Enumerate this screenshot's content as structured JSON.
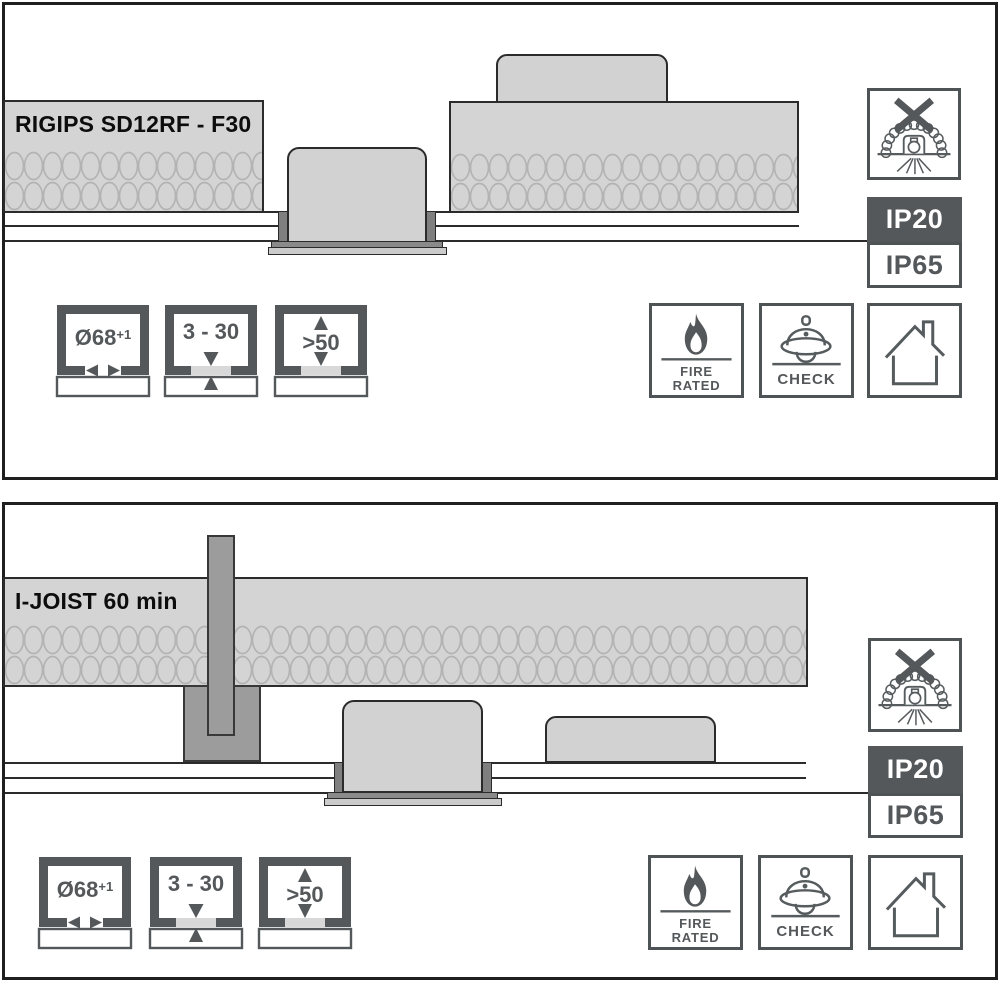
{
  "document": {
    "kind": "luminaire fire-rated ceiling installation diagram"
  },
  "panels": [
    {
      "label": "RIGIPS SD12RF - F30"
    },
    {
      "label": "I-JOIST 60 min"
    }
  ],
  "ratings": {
    "above_ceiling": "IP20",
    "below_ceiling": "IP65"
  },
  "dimensions": {
    "cutout": "Ø68",
    "cutout_tolerance": "+1",
    "ceiling_thickness": "3 - 30",
    "clearance": ">50"
  },
  "marks": {
    "fire_line1": "FIRE",
    "fire_line2": "RATED",
    "check": "CHECK"
  },
  "icons": {
    "no_insulation_cover": "no-insulation-cover-icon",
    "fire_rated": "fire-rated-icon",
    "helmet_check": "fire-helmet-check-icon",
    "house": "house-icon",
    "cutout": "cutout-diameter-icon",
    "thickness": "ceiling-thickness-icon",
    "clearance": "clearance-above-icon",
    "insulation": "insulation-loops"
  },
  "colors": {
    "panel_border": "#1f1f1f",
    "diagram_line": "#2b2b2b",
    "insulation_fill": "#d4d4d4",
    "insulation_loop": "#b3b3b3",
    "fixture_fill": "#d2d2d2",
    "clamp_fill": "#7f7f7f",
    "joist_fill": "#9c9c9c",
    "trim_dark": "#8a8a8a",
    "trim_light": "#cbcbcb",
    "accent_dark": "#54585a",
    "ip20_bg": "#54585a",
    "gap_segment": "#d8d8d8"
  }
}
